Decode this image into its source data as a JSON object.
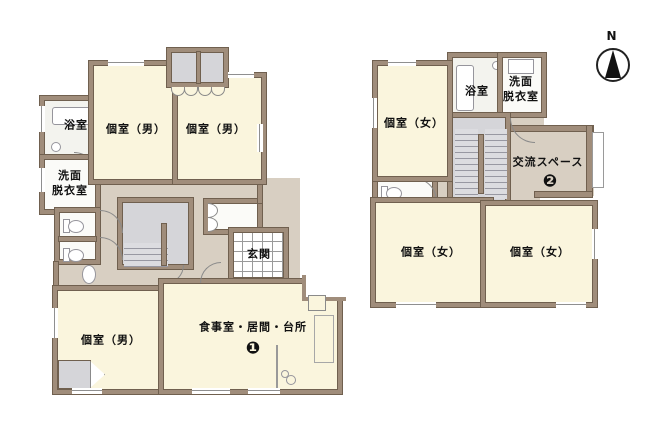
{
  "compass": {
    "north": "N"
  },
  "floor1": {
    "bath": "浴室",
    "washroom_line1": "洗面",
    "washroom_line2": "脱衣室",
    "room_male": "個室（男）",
    "entrance": "玄関",
    "dining_living_kitchen": "食事室・居間・台所",
    "dining_number": "❶"
  },
  "floor2": {
    "bath": "浴室",
    "washroom_line1": "洗面",
    "washroom_line2": "脱衣室",
    "room_female": "個室（女）",
    "lounge": "交流スペース",
    "lounge_number": "❷"
  },
  "colors": {
    "wall": "#a08d7b",
    "room_fill": "#faf5dd",
    "hall_fill": "#d8cfc2",
    "closet_fill": "#d5d5d9",
    "accent_text": "#111111"
  }
}
